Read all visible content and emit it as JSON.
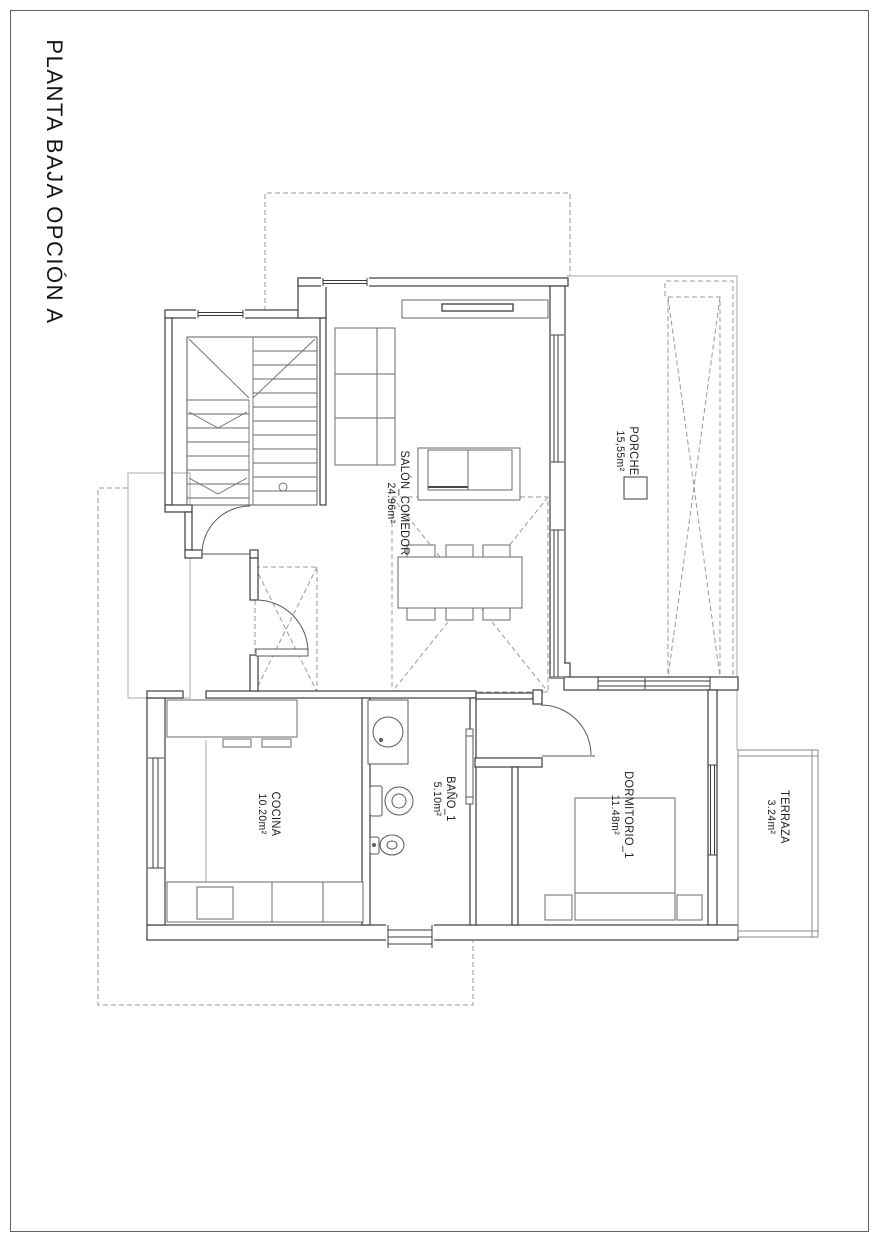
{
  "page": {
    "title": "PLANTA BAJA OPCIÓN A"
  },
  "rooms": [
    {
      "id": "salon-comedor",
      "label": "SALÓN_COMEDOR",
      "area": "24.96m²"
    },
    {
      "id": "porche",
      "label": "PORCHE",
      "area": "15,55m²"
    },
    {
      "id": "cocina",
      "label": "COCINA",
      "area": "10.20m²"
    },
    {
      "id": "bano-1",
      "label": "BAÑO_1",
      "area": "5.10m²"
    },
    {
      "id": "dormitorio-1",
      "label": "DORMITORIO_1",
      "area": "11.48m²"
    },
    {
      "id": "terraza",
      "label": "TERRAZA",
      "area": "3.24m²"
    }
  ],
  "colors": {
    "wall_line": "#3d3d3d",
    "furniture_line": "#6b6b6b",
    "dashed_line": "#9a9a9a",
    "overhang_line": "#b9b9b9",
    "text": "#1c1c1c"
  }
}
